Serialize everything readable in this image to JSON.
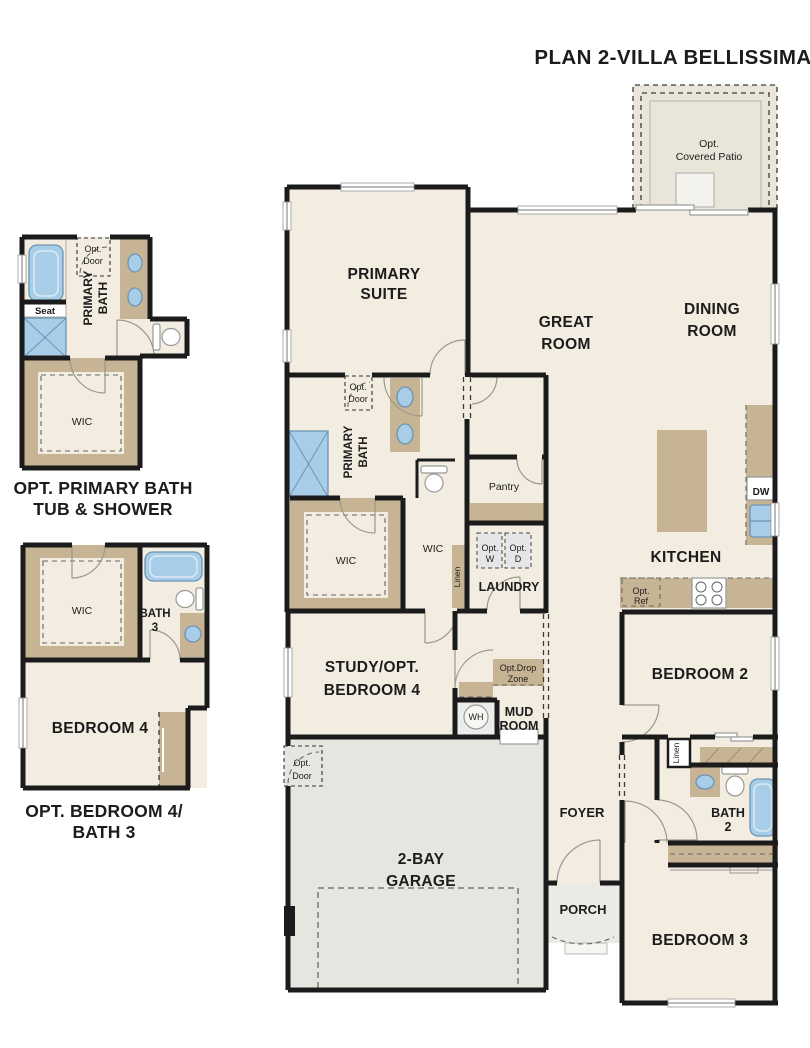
{
  "title": "PLAN 2-VILLA BELLISSIMA",
  "detail_top": {
    "caption1": "OPT. PRIMARY BATH",
    "caption2": "TUB & SHOWER",
    "opt_door1": "Opt.",
    "opt_door2": "Door",
    "primary": "PRIMARY",
    "bath": "BATH",
    "seat": "Seat",
    "wic": "WIC"
  },
  "detail_bottom": {
    "caption1": "OPT. BEDROOM 4/",
    "caption2": "BATH 3",
    "wic": "WIC",
    "bath": "BATH",
    "bath_num": "3",
    "bedroom": "BEDROOM 4"
  },
  "main": {
    "patio1": "Opt.",
    "patio2": "Covered Patio",
    "primary_suite1": "PRIMARY",
    "primary_suite2": "SUITE",
    "great1": "GREAT",
    "great2": "ROOM",
    "dining1": "DINING",
    "dining2": "ROOM",
    "kitchen": "KITCHEN",
    "opt_door1": "Opt.",
    "opt_door2": "Door",
    "primary_bath1": "PRIMARY",
    "primary_bath2": "BATH",
    "pantry": "Pantry",
    "wic1": "WIC",
    "wic2": "WIC",
    "linen1": "Linen",
    "linen2": "Linen",
    "opt_w1": "Opt.",
    "opt_w2": "W",
    "opt_d1": "Opt.",
    "opt_d2": "D",
    "laundry": "LAUNDRY",
    "dw": "DW",
    "opt_ref1": "Opt.",
    "opt_ref2": "Ref",
    "study1": "STUDY/OPT.",
    "study2": "BEDROOM 4",
    "dropzone1": "Opt.Drop",
    "dropzone2": "Zone",
    "wh": "WH",
    "mud1": "MUD",
    "mud2": "ROOM",
    "garage_opt1": "Opt.",
    "garage_opt2": "Door",
    "garage1": "2-BAY",
    "garage2": "GARAGE",
    "foyer": "FOYER",
    "porch": "PORCH",
    "bedroom2": "BEDROOM 2",
    "bath2_1": "BATH",
    "bath2_2": "2",
    "bedroom3": "BEDROOM 3"
  },
  "colors": {
    "floor": "#f2ede0",
    "wall": "#1b1b1b",
    "tan": "#c7b494",
    "fixture_blue": "#a8cde8",
    "garage": "#e7e5e0",
    "porch": "#eceae5",
    "patio": "#e9e5d9"
  }
}
